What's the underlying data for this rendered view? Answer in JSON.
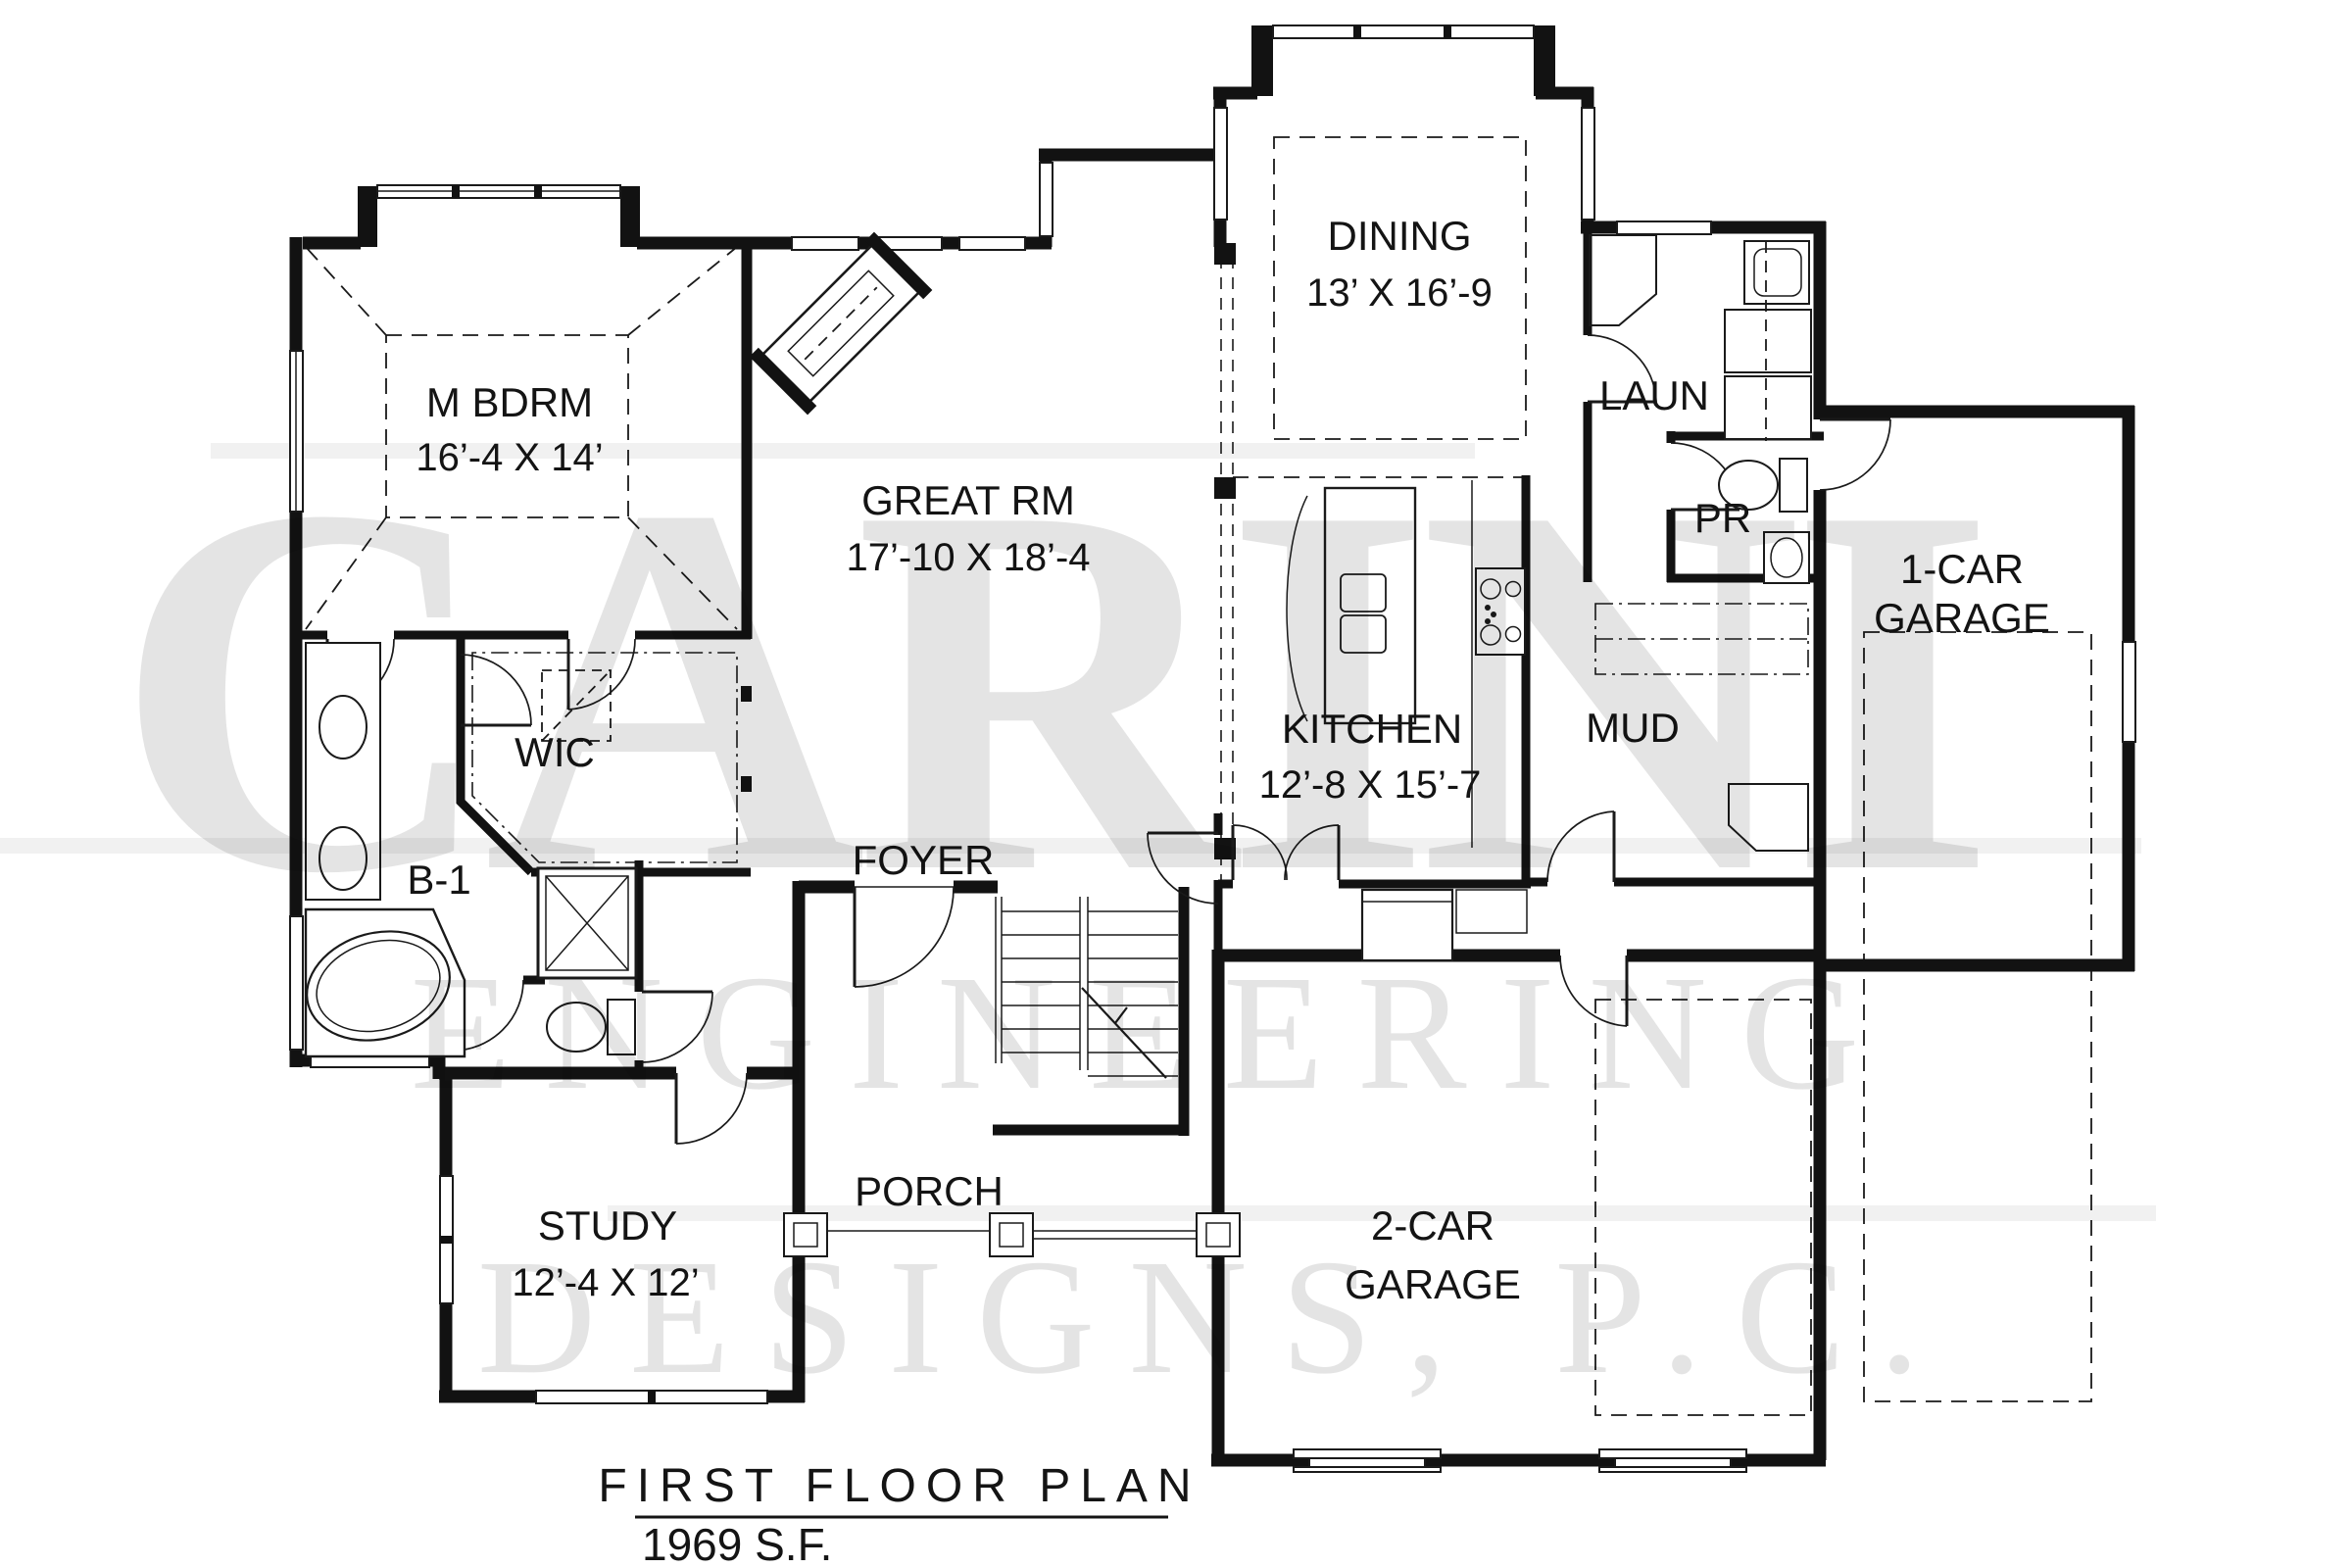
{
  "drawing": {
    "type": "architectural-first-floor-plan",
    "title_block": {
      "title": "FIRST FLOOR PLAN",
      "area": "1969 S.F."
    },
    "watermark": {
      "line1": "CARINI",
      "line2": "ENGINEERING",
      "line3": "DESIGNS,  P.C."
    }
  },
  "rooms": {
    "master_bedroom": {
      "name": "M BDRM",
      "dims": "16’-4 X 14’"
    },
    "great_room": {
      "name": "GREAT RM",
      "dims": "17’-10 X 18’-4"
    },
    "dining": {
      "name": "DINING",
      "dims": "13’ X 16’-9"
    },
    "kitchen": {
      "name": "KITCHEN",
      "dims": "12’-8 X 15’-7"
    },
    "laundry": {
      "name": "LAUN"
    },
    "powder_room": {
      "name": "PR"
    },
    "mud_room": {
      "name": "MUD"
    },
    "one_car_garage": {
      "line1": "1-CAR",
      "line2": "GARAGE"
    },
    "two_car_garage": {
      "line1": "2-CAR",
      "line2": "GARAGE"
    },
    "walk_in_closet": {
      "name": "WIC"
    },
    "bath_1": {
      "name": "B-1"
    },
    "foyer": {
      "name": "FOYER"
    },
    "porch": {
      "name": "PORCH"
    },
    "study": {
      "name": "STUDY",
      "dims": "12’-4 X 12’"
    }
  }
}
